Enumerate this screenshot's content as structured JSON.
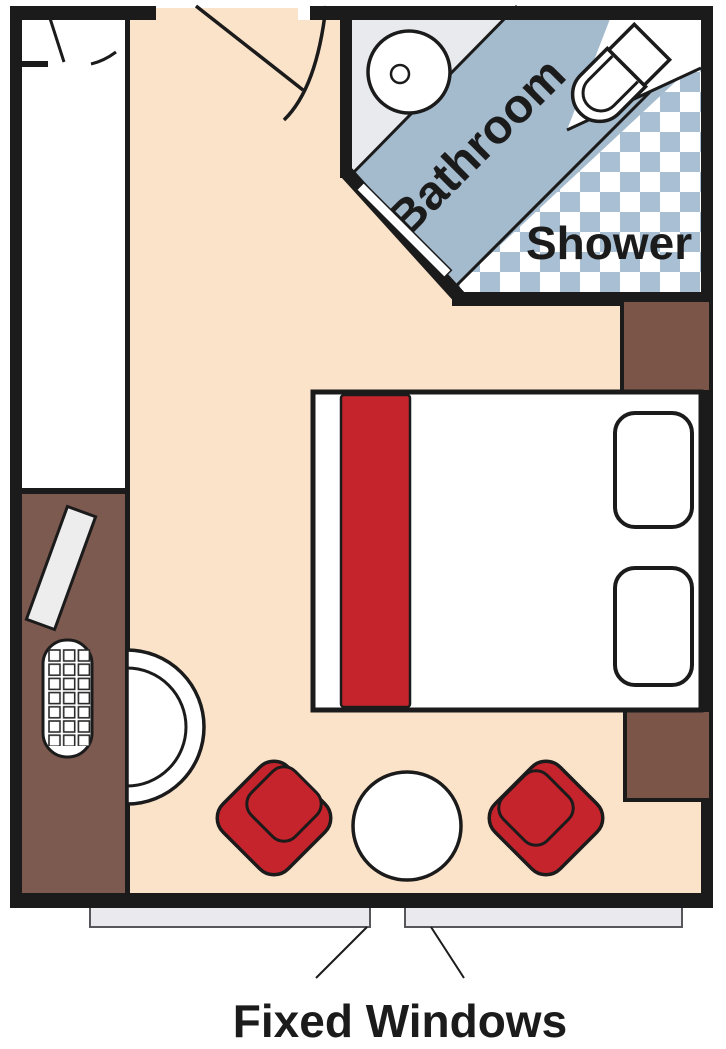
{
  "diagram": {
    "type": "floor-plan",
    "labels": {
      "bathroom": "Bathroom",
      "shower": "Shower",
      "fixed_windows": "Fixed Windows"
    },
    "colors": {
      "wall": "#1b1b1b",
      "floor": "#fbe3c9",
      "bathroom_floor": "#e8eaee",
      "bathroom_band": "#a4bacd",
      "checker_blue": "#a9bfd3",
      "accent_red": "#c5242c",
      "desk_brown": "#7d5a50",
      "nightstand_brown": "#7a5548",
      "window_glass": "#e9e9ee",
      "furniture_white": "#ffffff"
    }
  }
}
